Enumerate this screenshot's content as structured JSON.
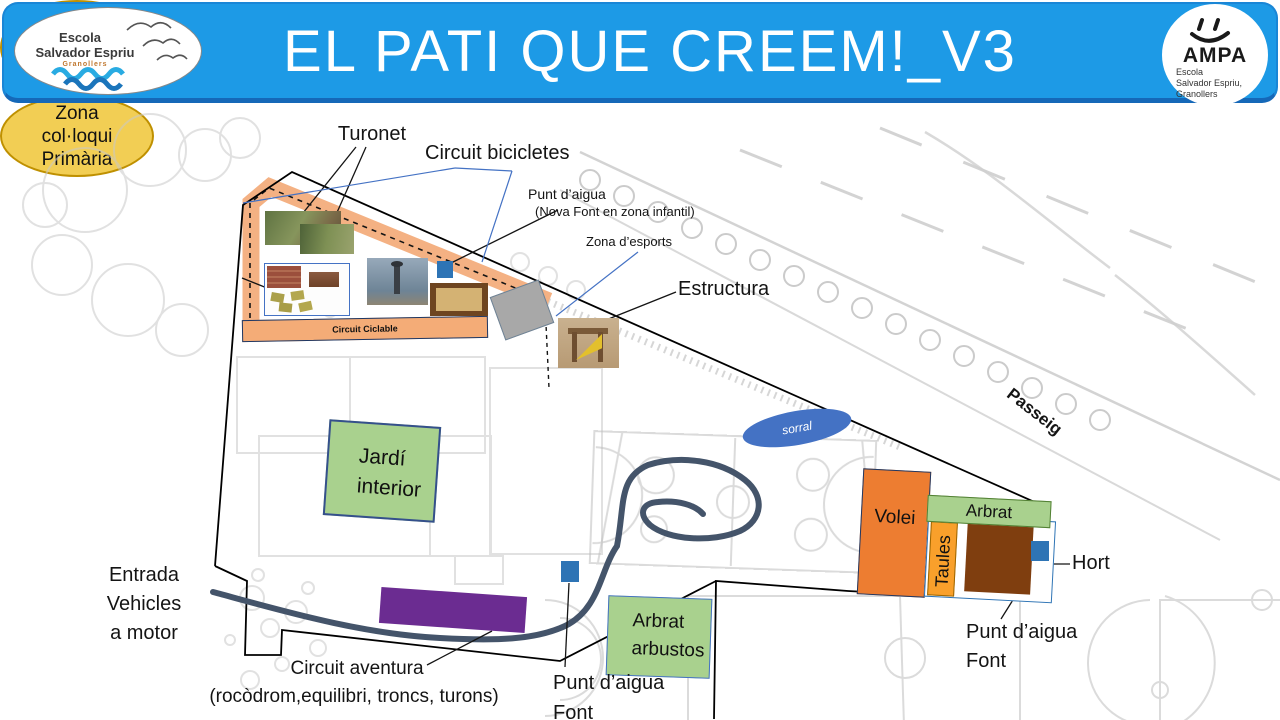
{
  "header": {
    "title": "EL PATI QUE CREEM!_V3"
  },
  "school_logo": {
    "line1": "Escola",
    "line2": "Salvador Espriu",
    "line3": "Granollers",
    "icon": "seagulls-and-waves"
  },
  "ampa_logo": {
    "name": "AMPA",
    "line1": "Escola",
    "line2": "Salvador Espriu,",
    "line3": "Granollers",
    "icon": "smiley-face"
  },
  "callouts": {
    "turonet": "Turonet",
    "circuit_bicicletes": "Circuit bicicletes",
    "punt_aigua_nova": "Punt d’aigua",
    "punt_aigua_nova_sub": "(Nova Font en zona infantil)",
    "zona_esports": "Zona d’esports",
    "estructura": "Estructura",
    "hort": "Hort",
    "passeig": "Passeig",
    "entrada_l1": "Entrada",
    "entrada_l2": "Vehicles",
    "entrada_l3": "a motor",
    "circuit_aventura": "Circuit aventura",
    "circuit_aventura_sub": "(rocòdrom,equilibri, troncs, turons)",
    "punt_aigua_left_l1": "Punt d’aigua",
    "punt_aigua_left_l2": "Font",
    "punt_aigua_right_l1": "Punt d’aigua",
    "punt_aigua_right_l2": "Font"
  },
  "zones": {
    "colloqui_infantil": {
      "l1": "Zona",
      "l2": "col·loqui",
      "l3": "infantil"
    },
    "colloqui_primaria": {
      "l1": "Zona",
      "l2": "col·loqui",
      "l3": "Primària"
    },
    "sorral": "sorral",
    "jardi_l1": "Jardí",
    "jardi_l2": "interior",
    "volei": "Volei",
    "arbrat": "Arbrat",
    "taules": "Taules",
    "arbrat_arbustos_l1": "Arbrat",
    "arbrat_arbustos_l2": "arbustos",
    "circuit_ciclable": "Circuit Ciclable"
  },
  "colors": {
    "header_blue": "#1d9ae6",
    "path_orange": "#f4b183",
    "zone_yellow": "#f2ce54",
    "zone_yellow_border": "#bf9000",
    "green": "#a9d18e",
    "green_border": "#538135",
    "volei_orange": "#ed7d31",
    "taules_orange": "#f9a02b",
    "purple": "#6b2c91",
    "water_blue": "#2e74b5",
    "sorral_blue": "#4472c4",
    "hort_brown": "#7f3e0f",
    "curve_slate": "#44546a",
    "plan_gray": "#c9c9c9"
  }
}
